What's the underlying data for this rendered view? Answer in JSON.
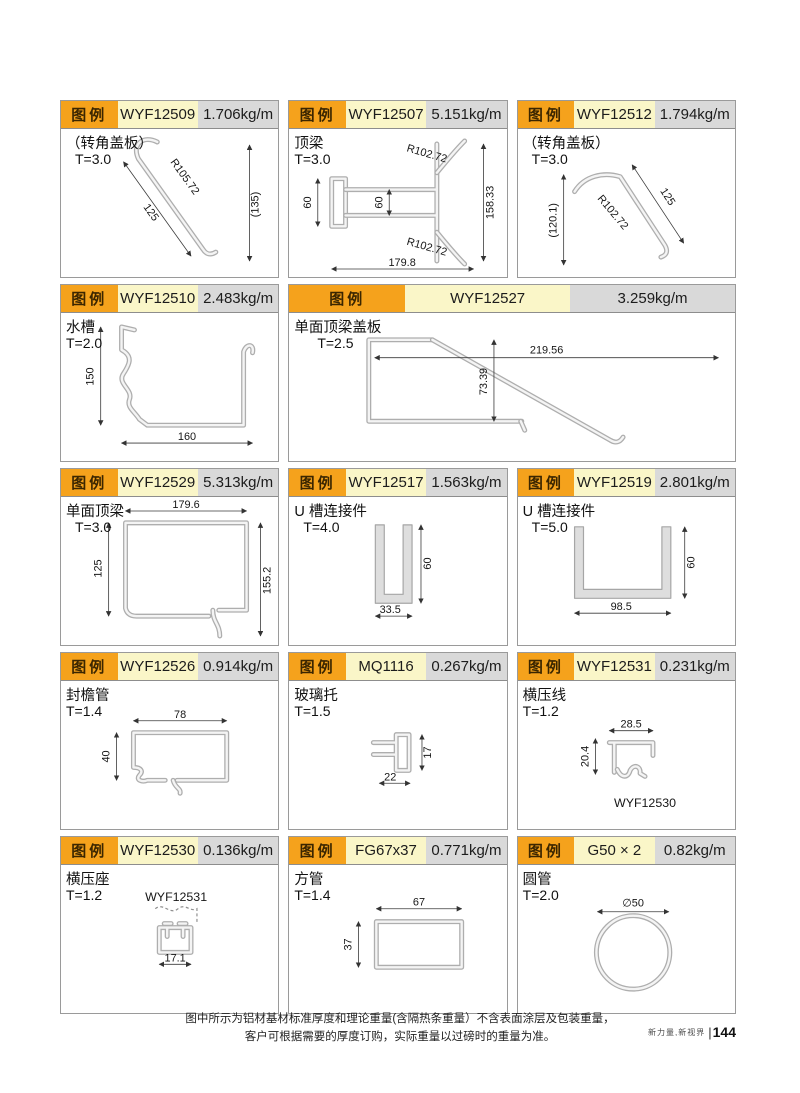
{
  "page": {
    "legend_label": "图例",
    "footer_line1": "图中所示为铝材基材标准厚度和理论重量(含隔热条重量）不含表面涂层及包装重量，",
    "footer_line2": "客户可根据需要的厚度订购，实际重量以过磅时的重量为准。",
    "brand": "新力量,新视界",
    "page_number": "144"
  },
  "colors": {
    "legend_bg": "#F5A21C",
    "code_bg": "#FAF6C8",
    "weight_bg": "#D9D9D9",
    "profile_line": "#AEAEAE"
  },
  "cells": [
    {
      "code": "WYF12509",
      "weight": "1.706kg/m",
      "name": "（转角盖板）",
      "thickness": "T=3.0",
      "dims": [
        "R105.72",
        "125",
        "(135)"
      ]
    },
    {
      "code": "WYF12507",
      "weight": "5.151kg/m",
      "name": "顶梁",
      "thickness": "T=3.0",
      "dims": [
        "R102.72",
        "60",
        "60",
        "158.33",
        "R102.72",
        "179.8"
      ]
    },
    {
      "code": "WYF12512",
      "weight": "1.794kg/m",
      "name": "（转角盖板）",
      "thickness": "T=3.0",
      "dims": [
        "R102.72",
        "125",
        "(120.1)"
      ]
    },
    {
      "code": "WYF12510",
      "weight": "2.483kg/m",
      "name": "水槽",
      "thickness": "T=2.0",
      "dims": [
        "150",
        "160"
      ]
    },
    {
      "code": "WYF12527",
      "weight": "3.259kg/m",
      "name": "单面顶梁盖板",
      "thickness": "T=2.5",
      "dims": [
        "219.56",
        "73.39"
      ]
    },
    {
      "code": "WYF12529",
      "weight": "5.313kg/m",
      "name": "单面顶梁",
      "thickness": "T=3.0",
      "dims": [
        "179.6",
        "125",
        "155.2"
      ]
    },
    {
      "code": "WYF12517",
      "weight": "1.563kg/m",
      "name": "U 槽连接件",
      "thickness": "T=4.0",
      "dims": [
        "60",
        "33.5"
      ]
    },
    {
      "code": "WYF12519",
      "weight": "2.801kg/m",
      "name": "U 槽连接件",
      "thickness": "T=5.0",
      "dims": [
        "60",
        "98.5"
      ]
    },
    {
      "code": "WYF12526",
      "weight": "0.914kg/m",
      "name": "封檐管",
      "thickness": "T=1.4",
      "dims": [
        "78",
        "40"
      ]
    },
    {
      "code": "MQ1116",
      "weight": "0.267kg/m",
      "name": "玻璃托",
      "thickness": "T=1.5",
      "dims": [
        "17",
        "22"
      ]
    },
    {
      "code": "WYF12531",
      "weight": "0.231kg/m",
      "name": "横压线",
      "thickness": "T=1.2",
      "dims": [
        "28.5",
        "20.4"
      ],
      "note": "WYF12530"
    },
    {
      "code": "WYF12530",
      "weight": "0.136kg/m",
      "name": "横压座",
      "thickness": "T=1.2",
      "dims": [
        "17.1"
      ],
      "note": "WYF12531"
    },
    {
      "code": "FG67x37",
      "weight": "0.771kg/m",
      "name": "方管",
      "thickness": "T=1.4",
      "dims": [
        "67",
        "37"
      ]
    },
    {
      "code": "G50 × 2",
      "weight": "0.82kg/m",
      "name": "圆管",
      "thickness": "T=2.0",
      "dims": [
        "∅50"
      ]
    }
  ]
}
